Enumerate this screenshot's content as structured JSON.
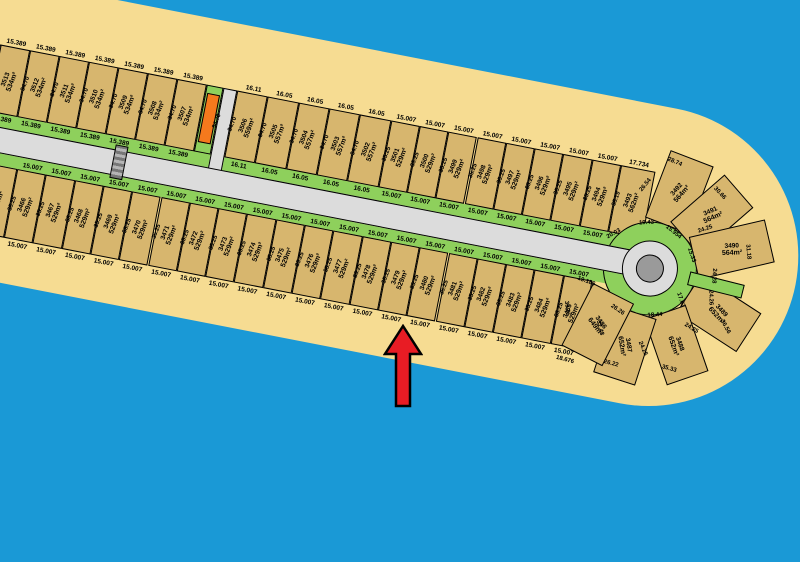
{
  "colors": {
    "water": "#1a99d6",
    "sand": "#f6dc92",
    "lot": "#d7b66e",
    "green": "#8ed05c",
    "road": "#dcdcdc",
    "island": "#9a9a9a",
    "orange": "#f5791d",
    "arrow": "#e81c24"
  },
  "map": {
    "top_row": [
      {
        "kind": "partial",
        "a": "534m²",
        "px": 20
      },
      {
        "n": "3513",
        "a": "534m²",
        "w": "15.389",
        "d": "34.70"
      },
      {
        "n": "3512",
        "a": "534m²",
        "w": "15.389",
        "d": "34.70"
      },
      {
        "n": "3511",
        "a": "534m²",
        "w": "15.389",
        "d": "34.70"
      },
      {
        "n": "3510",
        "a": "534m²",
        "w": "15.389",
        "d": "34.70"
      },
      {
        "n": "3509",
        "a": "534m²",
        "w": "15.389",
        "d": "34.70"
      },
      {
        "n": "3508",
        "a": "534m²",
        "w": "15.389",
        "d": "34.70"
      },
      {
        "n": "3507",
        "a": "534m²",
        "w": "15.389",
        "d": "34.70"
      },
      {
        "kind": "orange",
        "d": "34.70",
        "px": 17
      },
      {
        "kind": "lane",
        "px": 14
      },
      {
        "n": "3506",
        "a": "559m²",
        "w": "16.11",
        "d": "34.70"
      },
      {
        "n": "3505",
        "a": "557m²",
        "w": "16.05",
        "d": "34.70"
      },
      {
        "n": "3504",
        "a": "557m²",
        "w": "16.05",
        "d": "34.70"
      },
      {
        "n": "3503",
        "a": "557m²",
        "w": "16.05",
        "d": "34.70"
      },
      {
        "n": "3502",
        "a": "557m²",
        "w": "16.05",
        "d": "34.70"
      },
      {
        "n": "3501",
        "a": "529m²",
        "w": "15.007",
        "d": "35.25"
      },
      {
        "n": "3500",
        "a": "529m²",
        "w": "15.007",
        "d": "35.25"
      },
      {
        "n": "3499",
        "a": "529m²",
        "w": "15.007",
        "d": "35.25"
      },
      {
        "n": "3498",
        "a": "529m²",
        "w": "15.007",
        "d": "35.25"
      },
      {
        "n": "3497",
        "a": "529m²",
        "w": "15.007",
        "d": "35.25"
      },
      {
        "n": "3496",
        "a": "529m²",
        "w": "15.007",
        "d": "35.25"
      },
      {
        "n": "3495",
        "a": "529m²",
        "w": "15.007",
        "d": "35.25"
      },
      {
        "n": "3494",
        "a": "529m²",
        "w": "15.007",
        "d": "35.25"
      },
      {
        "n": "3493",
        "a": "562m²",
        "w": "17.734",
        "d": "35.19",
        "nb": true
      }
    ],
    "bottom_row": [
      {
        "kind": "partial",
        "a": "529m²",
        "px": 25
      },
      {
        "n": "3466",
        "a": "529m²",
        "w": "15.007",
        "d": "35.25"
      },
      {
        "n": "3467",
        "a": "529m²",
        "w": "15.007",
        "d": "35.25"
      },
      {
        "n": "3468",
        "a": "529m²",
        "w": "15.007",
        "d": "35.25"
      },
      {
        "n": "3469",
        "a": "529m²",
        "w": "15.007",
        "d": "35.25"
      },
      {
        "n": "3470",
        "a": "529m²",
        "w": "15.007",
        "d": "35.25"
      },
      {
        "n": "3471",
        "a": "529m²",
        "w": "15.007",
        "d": "35.25"
      },
      {
        "n": "3472",
        "a": "529m²",
        "w": "15.007",
        "d": "35.25"
      },
      {
        "n": "3473",
        "a": "529m²",
        "w": "15.007",
        "d": "35.25"
      },
      {
        "n": "3474",
        "a": "529m²",
        "w": "15.007",
        "d": "35.25"
      },
      {
        "n": "3475",
        "a": "529m²",
        "w": "15.007",
        "d": "35.25"
      },
      {
        "n": "3476",
        "a": "529m²",
        "w": "15.007",
        "d": "35.25"
      },
      {
        "n": "3477",
        "a": "529m²",
        "w": "15.007",
        "d": "35.25"
      },
      {
        "n": "3478",
        "a": "529m²",
        "w": "15.007",
        "d": "35.25"
      },
      {
        "n": "3479",
        "a": "529m²",
        "w": "15.007",
        "d": "35.25"
      },
      {
        "n": "3480",
        "a": "529m²",
        "w": "15.007",
        "d": "35.25"
      },
      {
        "n": "3481",
        "a": "529m²",
        "w": "15.007",
        "d": "35.25"
      },
      {
        "n": "3482",
        "a": "529m²",
        "w": "15.007",
        "d": "35.25"
      },
      {
        "n": "3483",
        "a": "529m²",
        "w": "15.007",
        "d": "35.25"
      },
      {
        "n": "3484",
        "a": "529m²",
        "w": "15.007",
        "d": "35.25"
      },
      {
        "n": "3485",
        "a": "529m²",
        "w": "15.007",
        "d": "35.25"
      }
    ],
    "cap_lots": [
      {
        "n": "3492",
        "a": "564m²"
      },
      {
        "n": "3491",
        "a": "564m²"
      },
      {
        "n": "3490",
        "a": "564m²"
      },
      {
        "n": "3489",
        "a": "652m²"
      },
      {
        "n": "3488",
        "a": "652m²"
      },
      {
        "n": "3487",
        "a": "652m²"
      },
      {
        "n": "3486",
        "a": "649m²"
      }
    ],
    "cap_dims": [
      "20.03",
      "19.43",
      "15.954",
      "15.33",
      "24.28",
      "24.26",
      "17.62",
      "18.44",
      "26.26",
      "19.186",
      "28.74",
      "26.54",
      "30.66",
      "24.25",
      "31.18",
      "36.56",
      "24.25",
      "35.33",
      "24.25",
      "26.22",
      "32.43",
      "18.676",
      "35.25"
    ]
  },
  "arrow": {
    "direction": "up"
  }
}
